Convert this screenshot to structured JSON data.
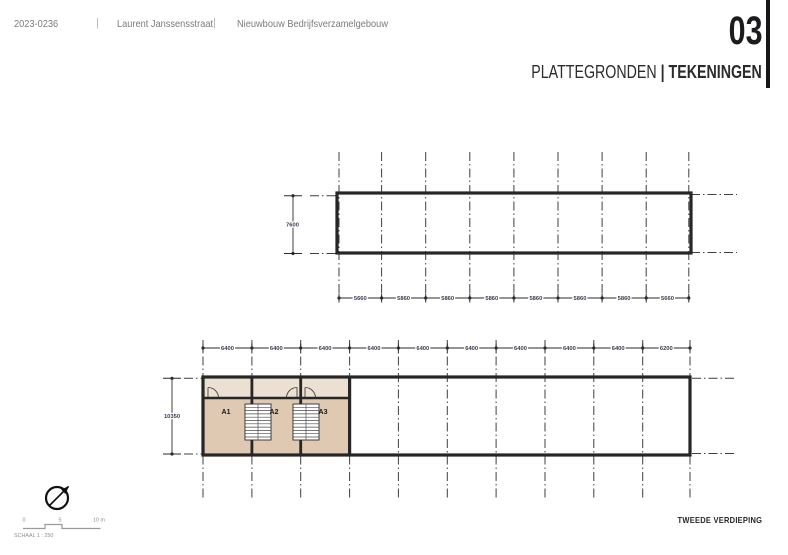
{
  "header": {
    "project_number": "2023-0236",
    "divider": "|",
    "address": "Laurent Janssensstraat",
    "project_name": "Nieuwbouw Bedrijfsverzamelgebouw",
    "sheet_number": "03",
    "sheet_title_primary": "PLATTEGRONDEN",
    "sheet_title_divider": "|",
    "sheet_title_secondary": "TEKENINGEN"
  },
  "drawing": {
    "top_plan": {
      "left_dim": "7600",
      "bay_dims": [
        "5660",
        "5860",
        "5860",
        "5860",
        "5860",
        "5860",
        "5860",
        "5660"
      ]
    },
    "bottom_plan": {
      "left_dim": "10350",
      "bay_dims": [
        "6400",
        "6400",
        "6400",
        "6400",
        "6400",
        "6400",
        "6400",
        "6400",
        "6400",
        "6200"
      ],
      "unit_labels": [
        "A1",
        "A2",
        "A3"
      ]
    }
  },
  "footer": {
    "scale_bar_ticks": [
      "0",
      "5",
      "10 m"
    ],
    "scale_label": "SCHAAL 1 : 250",
    "floor_label": "TWEEDE VERDIEPING"
  },
  "colors": {
    "unit_room_fill": "#e0c9b2",
    "unit_corridor_fill": "#ece0d2",
    "wall_ink": "#262626",
    "dimension_text": "#3a3a52",
    "header_text_gray": "#7b7b7b",
    "title_ink": "#1c1c1e"
  }
}
